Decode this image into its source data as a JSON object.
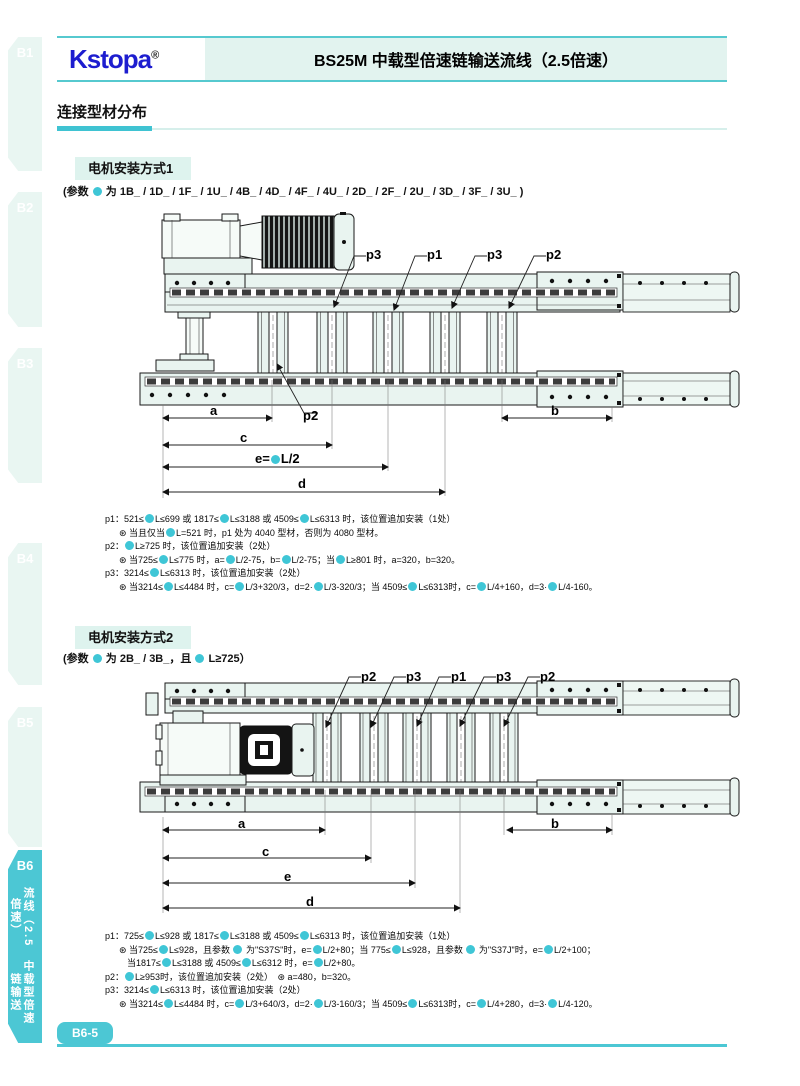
{
  "colors": {
    "accent": "#4cc7d4",
    "accent_light": "#e2f3ef",
    "logo_blue": "#1d1dcf",
    "dot": "#3fc6d6"
  },
  "header": {
    "logo": "Kstopa",
    "reg": "®",
    "title": "BS25M 中载型倍速链输送流线（2.5倍速）"
  },
  "sidebar": {
    "tabs": [
      "B1",
      "B2",
      "B3",
      "B4",
      "B5"
    ],
    "active": {
      "label": "B6",
      "col_right": "流线（2.5倍速）",
      "col_left": "中载型倍速链输送"
    }
  },
  "sections": {
    "profile_title": "连接型材分布"
  },
  "method1": {
    "heading": "电机安装方式1",
    "params": "(参数 ● 为 1B_ / 1D_ / 1F_ / 1U_ / 4B_ / 4D_ / 4F_ / 4U_ / 2D_ / 2F_ / 2U_ / 3D_ / 3F_ / 3U_ )",
    "callouts": [
      "p3",
      "p1",
      "p3",
      "p2"
    ],
    "callout_below": "p2",
    "dims": {
      "a": "a",
      "b": "b",
      "c": "c",
      "e": "e=●L/2",
      "d": "d"
    },
    "notes": [
      "p1：521≤●L≤699 或 1817≤●L≤3188 或 4509≤●L≤6313 时，该位置追加安装（1处）",
      "⊛ 当且仅当●L=521 时，p1 处为 4040 型材，否则为 4080 型材。",
      "p2：●L≥725 时，该位置追加安装（2处）",
      "⊛ 当725≤●L≤775 时，a=●L/2-75，b=●L/2-75；当●L≥801 时，a=320，b=320。",
      "p3：3214≤●L≤6313 时，该位置追加安装（2处）",
      "⊛ 当3214≤●L≤4484 时，c=●L/3+320/3，d=2·●L/3-320/3；当 4509≤●L≤6313时，c=●L/4+160，d=3·●L/4-160。"
    ]
  },
  "method2": {
    "heading": "电机安装方式2",
    "params": "(参数 ● 为 2B_ / 3B_，且 ● L≥725）",
    "callouts": [
      "p2",
      "p3",
      "p1",
      "p3",
      "p2"
    ],
    "dims": {
      "a": "a",
      "b": "b",
      "c": "c",
      "e": "e",
      "d": "d"
    },
    "notes": [
      "p1：725≤●L≤928 或 1817≤●L≤3188 或 4509≤●L≤6313 时，该位置追加安装（1处）",
      "⊛ 当725≤●L≤928，且参数 ● 为\"S37S\"时，e=●L/2+80；当 775≤●L≤928，且参数 ● 为\"S37J\"时，e=●L/2+100；",
      "当1817≤●L≤3188 或 4509≤●L≤6312 时，e=●L/2+80。",
      "p2：●L≥953时，该位置追加安装（2处）　⊛ a=480，b=320。",
      "p3：3214≤●L≤6313 时，该位置追加安装（2处）",
      "⊛ 当3214≤●L≤4484 时，c=●L/3+640/3，d=2·●L/3-160/3；当 4509≤●L≤6313时，c=●L/4+280，d=3·●L/4-120。"
    ]
  },
  "footer": {
    "page_tag": "B6-5"
  }
}
